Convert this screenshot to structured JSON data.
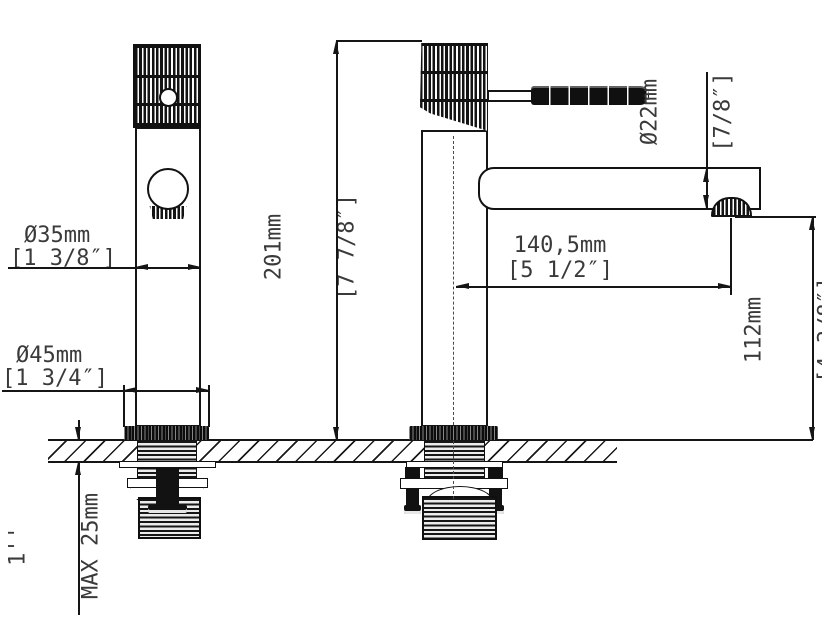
{
  "drawing": {
    "type": "technical-dimension-drawing",
    "subject": "single-lever basin mixer faucet, front and side views",
    "colors": {
      "background": "#ffffff",
      "line": "#151515",
      "text": "#3a3a3a"
    },
    "dimensions": {
      "body_diameter": {
        "mm": "Ø35mm",
        "inch": "[1 3/8″]"
      },
      "base_diameter": {
        "mm": "Ø45mm",
        "inch": "[1 3/4″]"
      },
      "total_height": {
        "mm": "201mm",
        "inch": "[7 7/8″]"
      },
      "spout_diameter": {
        "mm": "Ø22mm",
        "inch": "[7/8″]"
      },
      "spout_reach": {
        "mm": "140,5mm",
        "inch": "[5 1/2″]"
      },
      "spout_height": {
        "mm": "112mm",
        "inch": "[4 3/8″]"
      },
      "deck_thickness": {
        "line1": "1''",
        "line2": "MAX 25mm"
      }
    }
  }
}
